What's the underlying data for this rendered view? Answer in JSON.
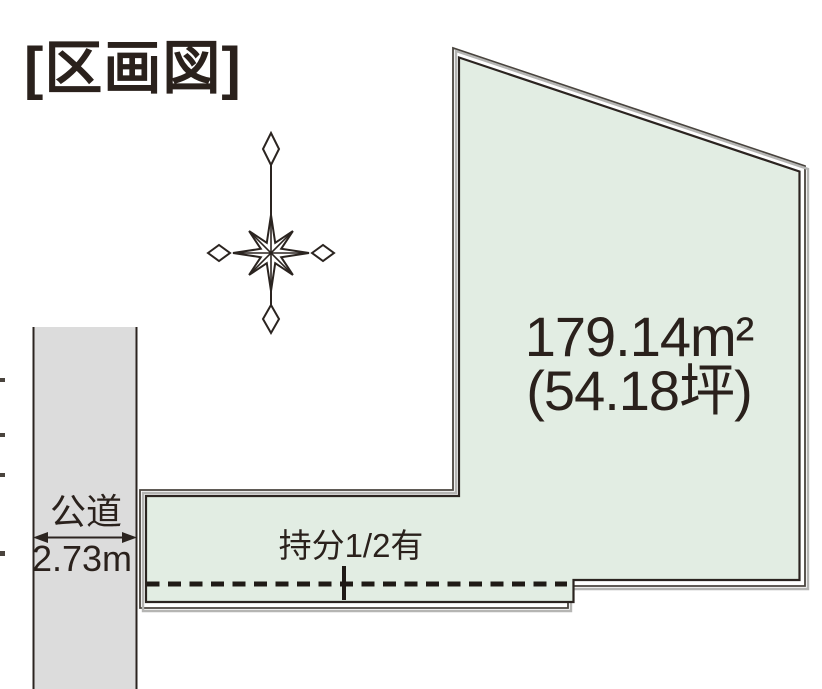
{
  "title": "[区画図]",
  "parcel": {
    "area_m2": "179.14m²",
    "area_tsubo": "(54.18坪)",
    "share_label": "持分1/2有"
  },
  "road": {
    "label": "公道",
    "width": "2.73m"
  },
  "icons": {
    "compass": "compass-rose-icon"
  },
  "colors": {
    "parcel_fill": "#e2ede3",
    "road_fill": "#dcdcdc",
    "ink": "#2b2420",
    "outer_line": "#49443e",
    "shadow": "#b5b5b3",
    "text": "#2a211c"
  }
}
